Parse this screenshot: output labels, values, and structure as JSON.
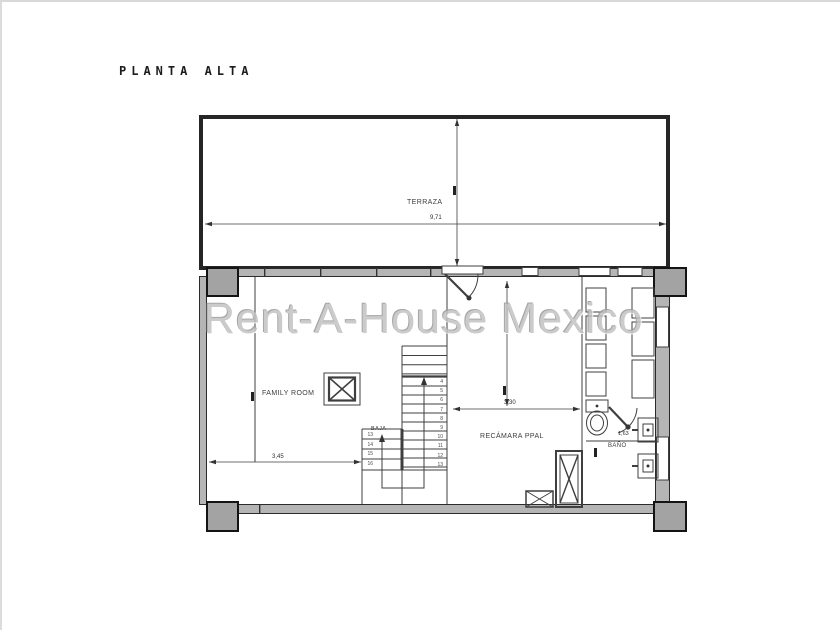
{
  "title": "PLANTA ALTA",
  "watermark": "Rent-A-House Mexico",
  "labels": {
    "terraza": "TERRAZA",
    "family_room": "FAMILY ROOM",
    "recamara": "RECÁMARA PPAL",
    "bano": "BAÑO",
    "baja": "BAJA"
  },
  "dimensions": {
    "terraza_width": "9,71",
    "family_width": "3,45",
    "recamara_width": "3,30",
    "bano_width": "1,63"
  },
  "stairs": {
    "right_steps": "4\n5\n6\n7\n8\n9\n10\n11\n12\n13",
    "left_steps": "13\n14\n15\n16"
  },
  "colors": {
    "wall_fill": "#b5b5b5",
    "column_fill": "#a3a3a3",
    "line": "#3f3f3f",
    "watermark": "#c2c2c2"
  }
}
